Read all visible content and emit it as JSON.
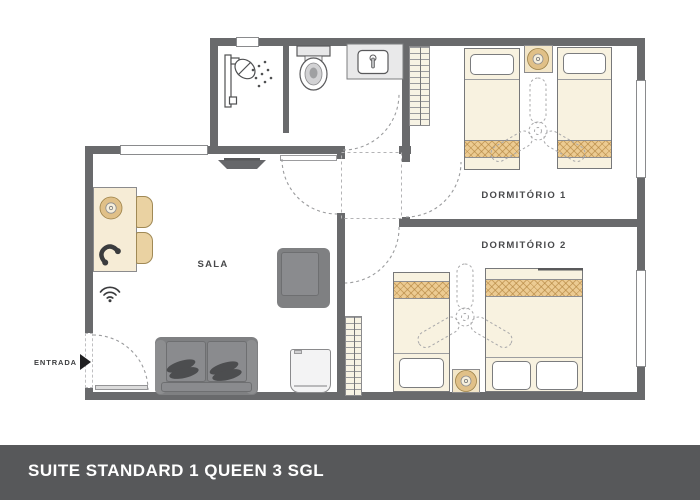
{
  "footer": {
    "title": "SUITE STANDARD 1 QUEEN 3 SGL",
    "bg_color": "#57585a",
    "text_color": "#ffffff"
  },
  "rooms": {
    "bedroom1": {
      "label": "DORMITÓRIO 1",
      "furniture": [
        "single-bed",
        "single-bed",
        "nightstand-with-lamp",
        "ceiling-fan",
        "wardrobe",
        "window"
      ]
    },
    "bedroom2": {
      "label": "DORMITÓRIO 2",
      "furniture": [
        "single-bed",
        "queen-bed",
        "nightstand-with-lamp",
        "ceiling-fan",
        "wardrobe",
        "window"
      ]
    },
    "living_room": {
      "label": "SALA",
      "furniture": [
        "desk-with-lamp-and-phone",
        "two-chairs",
        "wifi",
        "tv",
        "sofa",
        "armchair",
        "minibar"
      ]
    },
    "bathroom": {
      "furniture": [
        "shower",
        "toilet",
        "sink"
      ]
    },
    "entrance": {
      "label": "ENTRADA"
    }
  },
  "icons": {
    "shower": "shower-icon",
    "toilet": "toilet-icon",
    "sink": "sink-icon",
    "tv": "tv-icon",
    "phone": "phone-icon",
    "wifi": "wifi-icon",
    "ceiling_fan": "ceiling-fan-icon",
    "lamp": "lamp-icon",
    "entrance_arrow": "entrance-arrow-icon"
  },
  "colors": {
    "wall": "#696a6c",
    "floor": "#ffffff",
    "bed_linen": "#f8f2e0",
    "blanket_tan": "#eccb92",
    "blanket_lattice": "#c9a05e",
    "wood_accent": "#ddbb82",
    "furniture_gray": "#7f8082",
    "footer_bar": "#57585a"
  }
}
